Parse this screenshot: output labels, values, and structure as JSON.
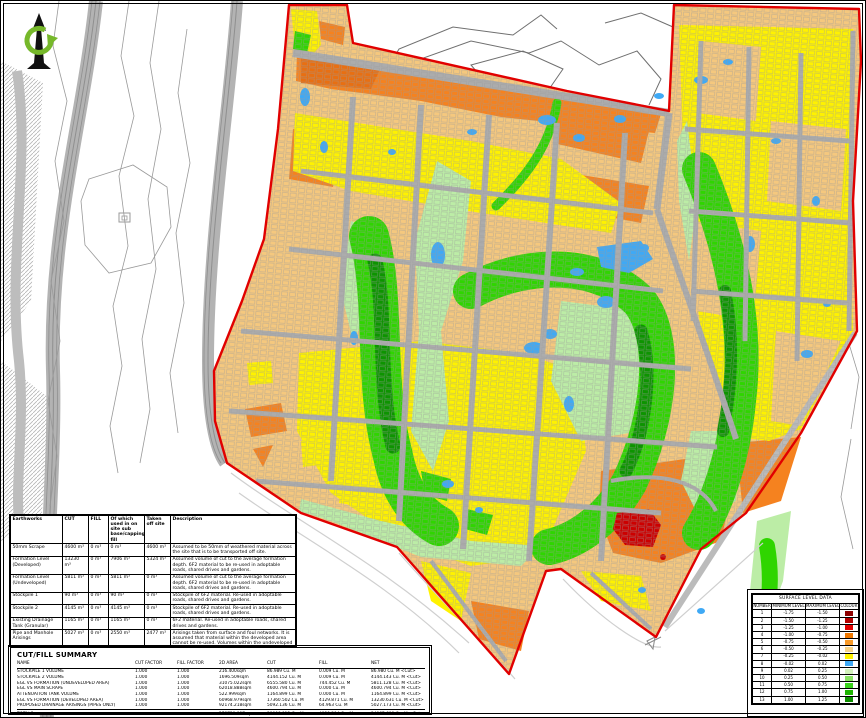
{
  "palette": {
    "tan": "#F5C87E",
    "orange": "#F5821F",
    "orange_dark": "#E86F12",
    "yellow": "#FFF200",
    "pale_green": "#BCEDA6",
    "bright_green": "#2FD500",
    "dark_green": "#0D9400",
    "blue": "#3FA9F5",
    "red_patch": "#CC0000",
    "boundary_red": "#E10000",
    "road_grey": "#ACACAC",
    "corridor_grey": "#B3B3B3",
    "corridor_line": "#8F8F8F",
    "contour_grey": "#9A9A9A",
    "contour_dark": "#6F6F6F",
    "faint_grey": "#CFCFCF"
  },
  "icons": {
    "north_arrow": "north-arrow"
  },
  "earthworks": {
    "headers": {
      "name": "Earthworks",
      "cut": "CUT",
      "fill": "FILL",
      "used": "Of which used in on site sub base/capping/general fill",
      "taken": "Taken off site",
      "description": "Description"
    },
    "rows": [
      {
        "name": "50mm Scrape",
        "cut": "4600 m³",
        "fill": "0 m³",
        "used": "0 m³",
        "taken": "4600 m³",
        "desc": "Assumed to be 50mm of weathered material across the site that is to be transported off site."
      },
      {
        "name": "Formation Level (Developed)",
        "cut": "13230 m³",
        "fill": "0 m³",
        "used": "7906 m³",
        "taken": "5324 m³",
        "desc": "Assumed volume of cut to the average formation depth. 6F2 material to be re-used in adoptable roads, shared drives and gardens."
      },
      {
        "name": "Formation Level (Undeveloped)",
        "cut": "5811 m³",
        "fill": "0 m³",
        "used": "5811 m³",
        "taken": "0 m³",
        "desc": "Assumed volume of cut to the average formation depth. 6F2 material to be re-used in adoptable roads, shared drives and gardens."
      },
      {
        "name": "Stockpile 1",
        "cut": "90 m³",
        "fill": "0 m³",
        "used": "90 m³",
        "taken": "0 m³",
        "desc": "Stockpile of 6F2 material. Re-used in adoptable roads, shared drives and gardens."
      },
      {
        "name": "Stockpile 2",
        "cut": "4145 m³",
        "fill": "0 m³",
        "used": "4145 m³",
        "taken": "0 m³",
        "desc": "Stockpile of 6F2 material. Re-used in adoptable roads, shared drives and gardens."
      },
      {
        "name": "Existing Drainage Tank (Granular)",
        "cut": "1165 m³",
        "fill": "0 m³",
        "used": "1165 m³",
        "taken": "0 m³",
        "desc": "6F2 material. Re-used in adoptable roads, shared drives and gardens."
      },
      {
        "name": "Pipe and Manhole Arisings",
        "cut": "5027 m³",
        "fill": "0 m³",
        "used": "2550 m³",
        "taken": "2477 m³",
        "desc": "Arisings taken from surface and foul networks. It is assumed that material within the developed area cannot be re-used. Volumes within the undeveloped area to be used as general fill."
      },
      {
        "name": "Proposed Attenuation Arisings*",
        "cut": "2700 m³",
        "fill": "0 m³",
        "used": "0 m³",
        "taken": "2700 m³",
        "desc": "Arisings taken from attenuation tanks. It is assumed that material within the developed area cannot be re-used. *Note this is not included in the cut/fill summary table."
      }
    ],
    "total": {
      "name": "TOTAL (excl. Scrape)",
      "cut": "36768 m³",
      "fill": "0 m³",
      "used": "21667 m³",
      "taken": "15101 m³",
      "desc": ""
    }
  },
  "summary": {
    "title": "CUT/FILL SUMMARY",
    "headers": {
      "name": "NAME",
      "cut_factor": "CUT FACTOR",
      "fill_factor": "FILL FACTOR",
      "area": "2D AREA",
      "cut": "CUT",
      "fill": "FILL",
      "net": "NET"
    },
    "rows": [
      {
        "name": "STOCKPILE 1 VOLUME",
        "cf": "1.000",
        "ff": "1.000",
        "area": "216.400sqm",
        "cut": "86.989 Cu. M",
        "fill": "0.009 Cu. M",
        "net": "86.980 Cu. M <Cut>"
      },
      {
        "name": "STOCKPILE 2 VOLUME",
        "cf": "1.000",
        "ff": "1.000",
        "area": "1696.509sqm",
        "cut": "4144.152 Cu. M",
        "fill": "0.009 Cu. M",
        "net": "4144.143 Cu. M <Cut>"
      },
      {
        "name": "EGL VS FORMATION (UNDEVELOPED AREA)",
        "cf": "1.000",
        "ff": "1.000",
        "area": "31075.022sqm",
        "cut": "6555.580 Cu. M",
        "fill": "744.452 Cu. M",
        "net": "5811.128 Cu. M <Cut>"
      },
      {
        "name": "EGL VS MAIN SCRAPE",
        "cf": "1.000",
        "ff": "1.000",
        "area": "62018.888sqm",
        "cut": "4600.794 Cu. M",
        "fill": "0.000 Cu. M",
        "net": "4600.794 Cu. M <Cut>"
      },
      {
        "name": "ATTENUATION TANK VOLUME",
        "cf": "1.000",
        "ff": "1.000",
        "area": "522.999sqm",
        "cut": "1164.899 Cu. M",
        "fill": "0.000 Cu. M",
        "net": "1164.899 Cu. M <Cut>"
      },
      {
        "name": "EGL VS FORMATION (DEVELOPED AREA)",
        "cf": "1.000",
        "ff": "1.000",
        "area": "60968.979sqm",
        "cut": "17360.502 Cu. M",
        "fill": "4129.871 Cu. M",
        "net": "13230.631 Cu. M <Cut>"
      },
      {
        "name": "PROPOSED DRAINAGE ARISINGS (PIPES ONLY)",
        "cf": "1.000",
        "ff": "1.000",
        "area": "92174.218sqm",
        "cut": "5092.136 Cu. M",
        "fill": "64.963 Cu. M",
        "net": "5027.173 Cu. M <Cut>"
      }
    ],
    "totals": {
      "name": "TOTALS",
      "cf": "",
      "ff": "",
      "area": "278730.097sqm",
      "cut": "39006.912 Cu. M",
      "fill": "4939.304 Cu. M",
      "net": "34067.608 Cu. M <Cut>"
    }
  },
  "legend": {
    "title": "SURFACE LEVEL DATA",
    "headers": {
      "number": "NUMBER",
      "min": "MINIMUM LEVEL",
      "max": "MAXIMUM LEVEL",
      "colour": "COLOUR"
    },
    "rows": [
      {
        "number": "1",
        "min": "-1.75",
        "max": "-1.50",
        "colour": "#8E0000"
      },
      {
        "number": "2",
        "min": "-1.50",
        "max": "-1.25",
        "colour": "#B40000"
      },
      {
        "number": "3",
        "min": "-1.25",
        "max": "-1.00",
        "colour": "#E00000"
      },
      {
        "number": "4",
        "min": "-1.00",
        "max": "-0.75",
        "colour": "#F07800"
      },
      {
        "number": "5",
        "min": "-0.75",
        "max": "-0.50",
        "colour": "#F89A28"
      },
      {
        "number": "6",
        "min": "-0.50",
        "max": "-0.25",
        "colour": "#F8D488"
      },
      {
        "number": "7",
        "min": "-0.25",
        "max": "-0.02",
        "colour": "#FFF200"
      },
      {
        "number": "8",
        "min": "-0.02",
        "max": "0.02",
        "colour": "#3FA9F5"
      },
      {
        "number": "9",
        "min": "0.02",
        "max": "0.25",
        "colour": "#D4F2BC"
      },
      {
        "number": "10",
        "min": "0.25",
        "max": "0.50",
        "colour": "#8CE465"
      },
      {
        "number": "11",
        "min": "0.50",
        "max": "0.75",
        "colour": "#3CD41E"
      },
      {
        "number": "12",
        "min": "0.75",
        "max": "1.00",
        "colour": "#1EB400"
      },
      {
        "number": "13",
        "min": "1.00",
        "max": "1.25",
        "colour": "#0E8E00"
      }
    ]
  }
}
